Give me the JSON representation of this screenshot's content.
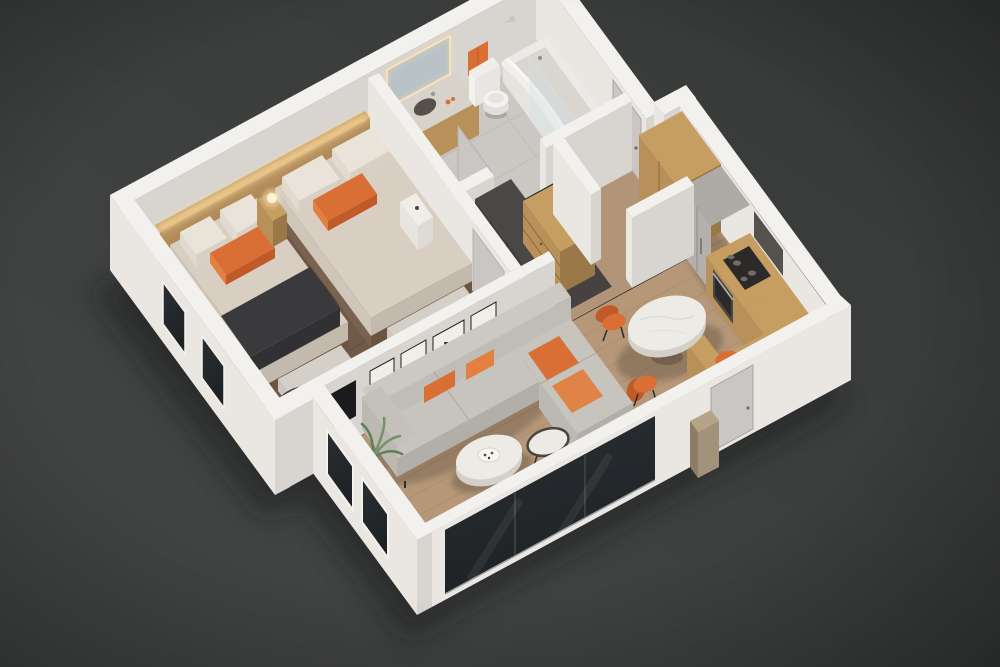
{
  "scene": {
    "type": "3d-floorplan-render",
    "view": "isometric dollhouse cutaway, viewed from above",
    "description": "Photorealistic isometric 3D render of a one-bedroom apartment floor plan on a dark gray studio background: bedroom with two beds, bathroom, hallway closet, open living room with L-shaped sectional, dining area and oak kitchen",
    "background": "dark charcoal gray"
  },
  "palette": {
    "bg1": "#454747",
    "bg2": "#363838",
    "shadowCol": "#141515",
    "wallTop": "#f3f1ee",
    "wallLit": "#eae7e3",
    "wallShade": "#d8d4d0",
    "floorBed": "#6f5949",
    "plankBed": "#5e4a3d",
    "floorLiv": "#b69879",
    "plankLiv": "#a3866a",
    "floorBath": "#cbc8c3",
    "tileLine": "#b7b4af",
    "floorCloset": "#474241",
    "floorEntry": "#b29478",
    "oakTop": "#c79e62",
    "oakFront": "#b8905a",
    "oakSide": "#9a7847",
    "oakDark": "#8a6a3e",
    "oakLight": "#c7a263",
    "steel": "#b4b1ad",
    "steelDark": "#8f8c89",
    "darkCab": "#403e3d",
    "darkCabSide": "#343231",
    "darkCabTop": "#4a4847",
    "bedding": "#d8cec2",
    "beddingSide": "#c4b9ad",
    "beddingLit": "#cfc5b9",
    "pillowWhite": "#eae3d9",
    "pillowShade": "#d8d0c4",
    "pillowLit": "#e2dad0",
    "orange": "#d96f35",
    "orangeDark": "#c05a28",
    "orangeLight": "#e2803f",
    "throwDark": "#3a393b",
    "throwSide": "#313033",
    "sofaTop": "#c7c3bd",
    "sofaSide": "#b2aea8",
    "sofaLit": "#bcb8b2",
    "sofaBack": "#c0bcb6",
    "sofaBackTop": "#ccc8c2",
    "benchTop": "#d4d0c9",
    "benchSide": "#c2beb7",
    "benchLit": "#cbc7c0",
    "bedFrame": "#6b5440",
    "bedFrameLit": "#7a6250",
    "marbleTop": "#edebe6",
    "marbleSide": "#d4d0c9",
    "glass1": "#2a2f33",
    "glass2": "#1e2225",
    "glow": "#ffdca4",
    "lamp": "#fff3d4",
    "doorGray": "#cac6c4",
    "tv": "#1b1b1d",
    "art": "#20201f",
    "leaf1": "#5f7f56",
    "leaf2": "#74936a",
    "white": "#f6f4f1"
  },
  "rooms": {
    "bedroom": {
      "label": "Bedroom",
      "floor": "dark wood planks",
      "furniture": [
        "double bed",
        "single bed with charcoal throw",
        "backlit oak headboard panel",
        "nightstand with glowing lamp",
        "white side table",
        "two upholstered benches",
        "black side table",
        "orange accent armchair",
        "glowing floor lamp"
      ],
      "accents": [
        "orange lumbar pillows"
      ]
    },
    "bathroom": {
      "label": "Bathroom",
      "floor": "gray tile",
      "furniture": [
        "oak vanity with sink",
        "LED backlit mirror",
        "toilet",
        "orange hand towel",
        "bathtub with glass screen",
        "white shower curtain",
        "shower fixture"
      ]
    },
    "hallway": {
      "label": "Hallway / Closet",
      "floor": "dark closet floor and oak entry floor",
      "furniture": [
        "dark wardrobe",
        "oak dresser with drawers",
        "closet rod with hangers",
        "entry door",
        "closet door"
      ]
    },
    "living_room": {
      "label": "Living Room",
      "floor": "light oak planks",
      "furniture": [
        "L-shaped gray sectional sofa",
        "orange throw pillows",
        "round marble coffee table",
        "round side table",
        "orange armchair",
        "palm plant",
        "glowing floor lamp",
        "wall TV",
        "black city-skyline wall art",
        "floor-to-ceiling window"
      ]
    },
    "kitchen": {
      "label": "Kitchen",
      "furniture": [
        "oak tall pantry",
        "built-in stainless fridge",
        "oven with black cooktop",
        "oak counter with L-return",
        "tall oak end cabinet",
        "dark backsplash hood panel",
        "outdoor utility box"
      ]
    },
    "dining": {
      "label": "Dining Area",
      "furniture": [
        "round white marble dining table",
        "three orange dining chairs"
      ]
    }
  }
}
